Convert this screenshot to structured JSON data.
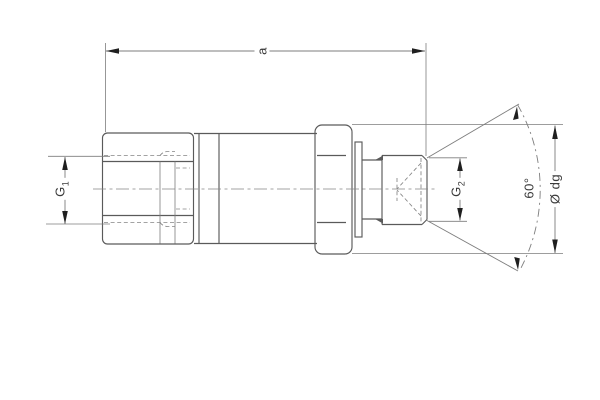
{
  "drawing": {
    "title": "threaded-adapter-technical-drawing",
    "labels": {
      "dim_a": "a",
      "g1_base": "G",
      "g1_sub": "1",
      "g2_base": "G",
      "g2_sub": "2",
      "angle": "60°",
      "diameter": "Ø dg"
    },
    "colors": {
      "background": "#ffffff",
      "line": "#5a5a5a",
      "thin_line": "#7d7d7d",
      "arrow": "#1f1f1f",
      "text": "#3a3a3a"
    }
  }
}
